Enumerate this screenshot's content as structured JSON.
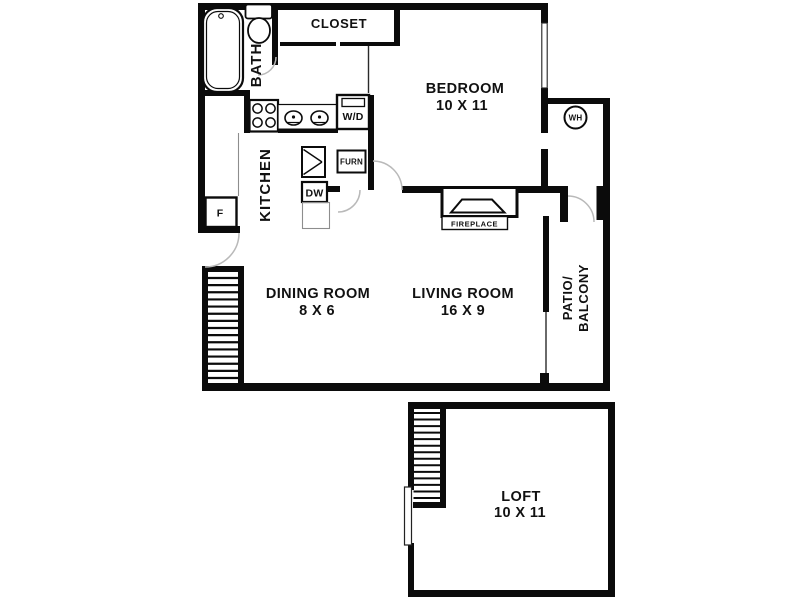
{
  "plan": {
    "rooms": {
      "closet": {
        "label": "CLOSET"
      },
      "bedroom": {
        "label": "BEDROOM",
        "dims": "10 X 11"
      },
      "bath": {
        "label": "BATH"
      },
      "kitchen": {
        "label": "KITCHEN"
      },
      "dining": {
        "label": "DINING ROOM",
        "dims": "8 X 6"
      },
      "living": {
        "label": "LIVING ROOM",
        "dims": "16 X 9"
      },
      "patio": {
        "label_line1": "PATIO/",
        "label_line2": "BALCONY"
      },
      "loft": {
        "label": "LOFT",
        "dims": "10 X 11"
      }
    },
    "fixtures": {
      "washer_dryer": "W/D",
      "furnace": "FURN",
      "dishwasher": "DW",
      "refrigerator": "F",
      "water_heater": "WH",
      "fireplace": "FIREPLACE"
    },
    "colors": {
      "wall": "#0b0b0b",
      "background": "#ffffff",
      "door_arc": "#b9b9b9"
    }
  }
}
